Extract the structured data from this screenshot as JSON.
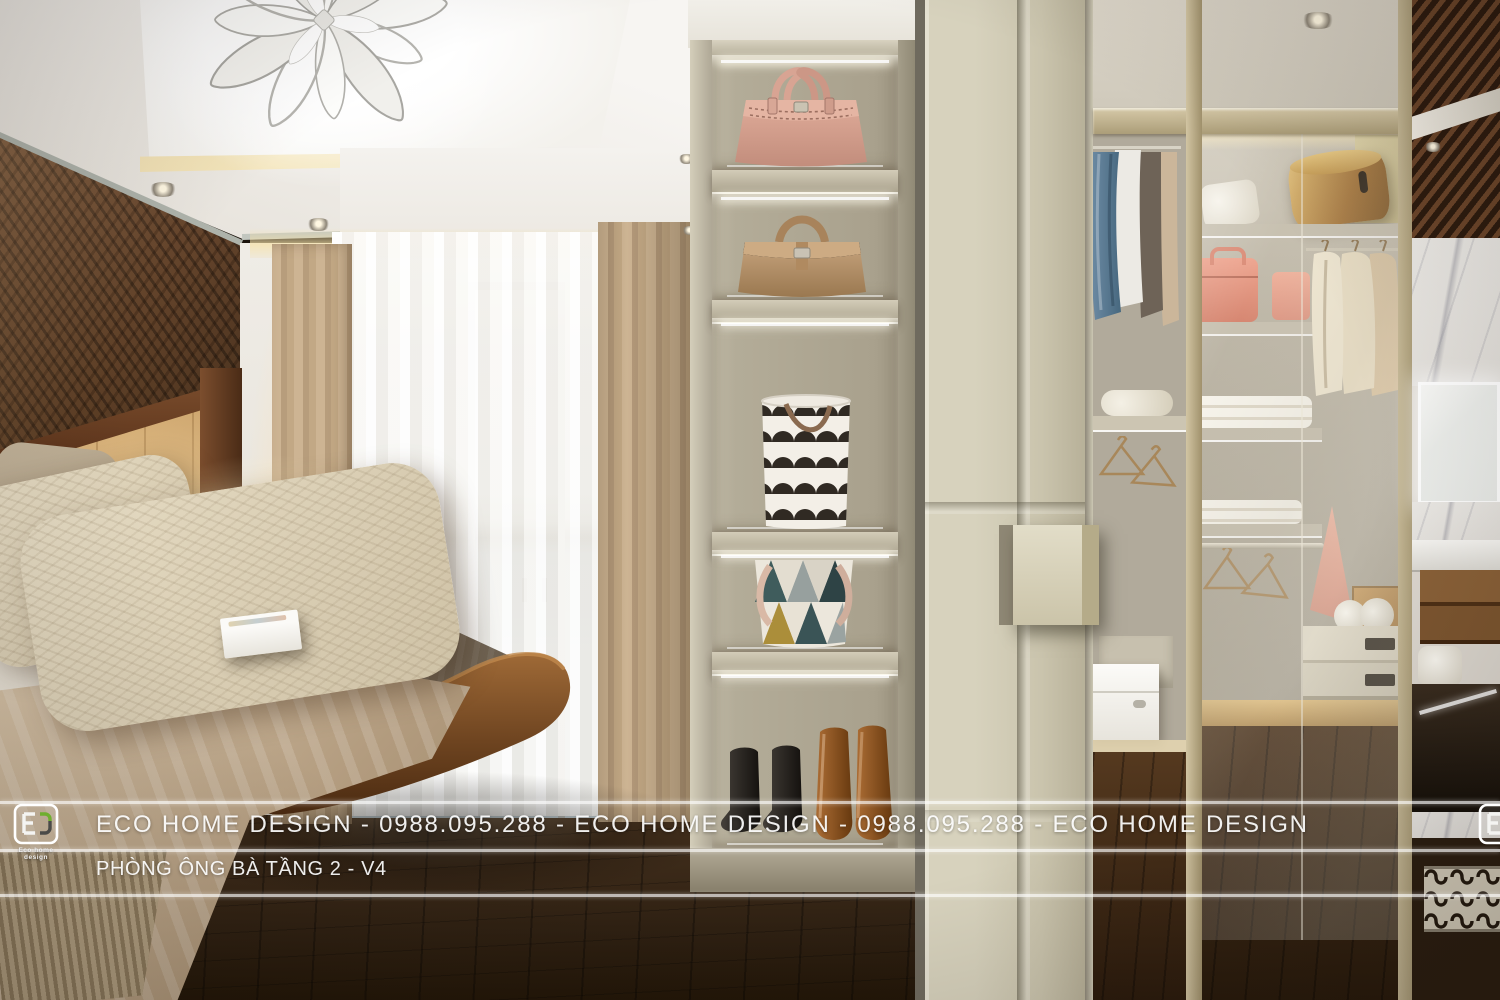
{
  "meta": {
    "domain": "Natural-Image",
    "description": "Photorealistic 3D interior rendering of a master bedroom with backlit display shelving and a walk-in wardrobe",
    "view": "perspective render"
  },
  "watermark": {
    "banner": "ECO HOME DESIGN - 0988.095.288 - ECO HOME DESIGN - 0988.095.288 - ECO HOME DESIGN",
    "brand": "ECO HOME DESIGN",
    "phone": "0988.095.288",
    "caption": "PHÒNG ÔNG BÀ TẦNG 2 - V4",
    "logo": {
      "monogram": "E",
      "label": "Eco home design"
    }
  },
  "scene": {
    "room": "bedroom with walk-in closet",
    "objects": [
      "flower petal chandelier",
      "tray ceiling with cove lighting",
      "recessed spotlights",
      "geometric walnut feature wall",
      "light oak headboard panel",
      "bedside lamp",
      "bed with beige pillows",
      "taupe blanket",
      "beige throw with fringe",
      "white box on bed",
      "sheer curtains",
      "beige drapes",
      "balcony glass door",
      "backlit display column",
      "pink handbag",
      "tan handbag",
      "black and white scalloped basket",
      "geometric triangle basket",
      "black ankle boots",
      "brown knee-high boots",
      "sage sliding wardrobe door",
      "walk-in closet",
      "hanging shirts",
      "empty bronze hangers",
      "folded towels",
      "gold hat box",
      "pink suitcases",
      "white storage boxes",
      "drawer unit",
      "lit vanity mirror",
      "marble wall",
      "wood slat ceiling feature",
      "metal scroll grille cabinet",
      "dark hardwood floor"
    ]
  },
  "palette": {
    "ceiling": "#f3f1ed",
    "cove_light": "#f1dfae",
    "wood_wall": "#5d3f2b",
    "headboard_oak": "#d3ad78",
    "drape_beige": "#c3a987",
    "sheer_white": "#f4f2ee",
    "blanket_taupe": "#7c6f5e",
    "throw_beige": "#c0ab8d",
    "floor_walnut": "#402d1c",
    "shelf_unit": "#b3ab97",
    "niche_glow": "#f0e8d7",
    "door_sage": "#cdc7b1",
    "handbag_pink": "#d8a694",
    "handbag_tan": "#b5906a",
    "frame_champagne": "#c0b291",
    "boots_brown": "#9c5f2b",
    "marble_white": "#e9e7e3",
    "logo_green": "#6fae2f",
    "watermark_text": "#ffffff"
  }
}
